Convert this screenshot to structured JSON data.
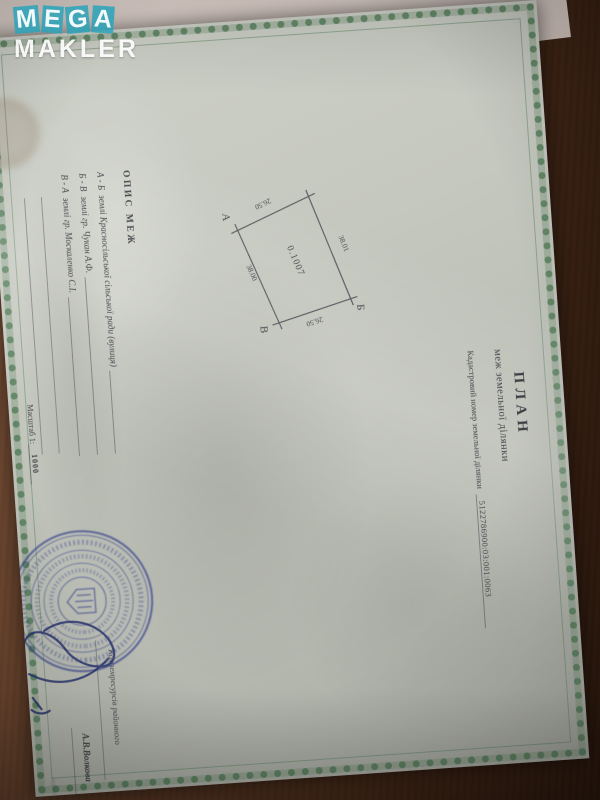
{
  "watermark": {
    "letters": [
      "M",
      "E",
      "G",
      "A"
    ],
    "line2": "MAKLER",
    "tile_color": "#2aa3ba"
  },
  "document": {
    "title": "ПЛАН",
    "subtitle": "меж земельної ділянки",
    "cadastral": {
      "label": "Кадастровий номер земельної ділянки",
      "number": "5122786900:03:001:0063"
    },
    "plot": {
      "area": "0.1007",
      "vertex_a": "А",
      "vertex_b": "Б",
      "vertex_v": "В",
      "side_left": "26.50",
      "side_top": "38.01",
      "side_right": "26.50",
      "side_bottom": "38.00"
    },
    "boundaries": {
      "header": "ОПИС МЕЖ",
      "items": [
        {
          "from_to": "А - Б",
          "text": "землі Красносільської сільської ради (вулиця)"
        },
        {
          "from_to": "Б - В",
          "text": "землі гр. Чукан А.Ф."
        },
        {
          "from_to": "В - А",
          "text": "землі гр. Москаленко С.І."
        }
      ]
    },
    "scale": {
      "label": "Масштаб 1:",
      "value": "1000"
    },
    "approval": {
      "org_line": "Комземресурсів районного",
      "name": "А.В.Волкова",
      "small_label": "підпис"
    }
  }
}
